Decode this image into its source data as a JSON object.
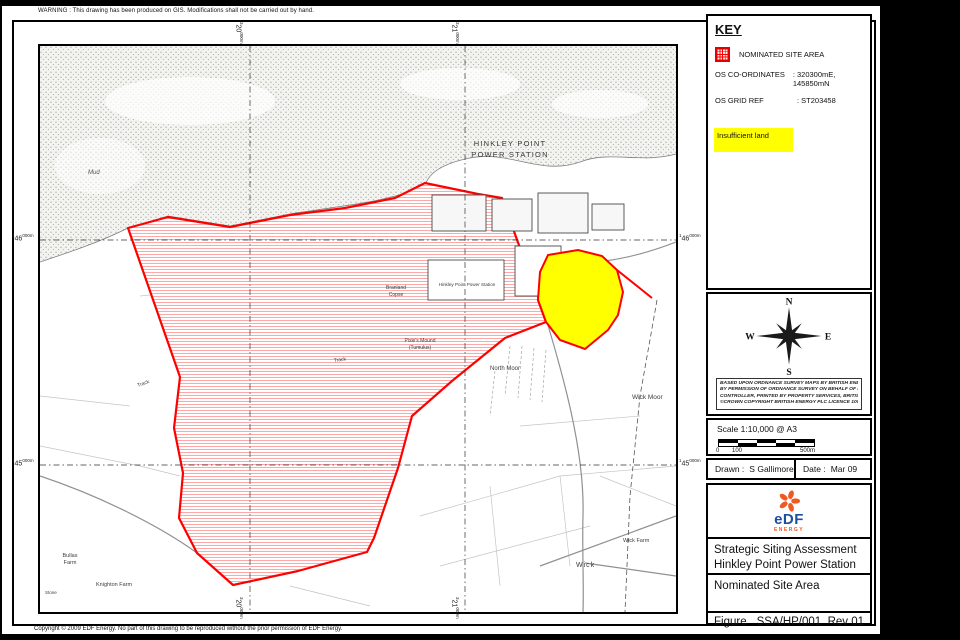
{
  "page": {
    "warning": "WARNING : This drawing has been produced on GIS. Modifications shall not be carried out by hand.",
    "copyright": "Copyright © 2009 EDF Energy. No part of this drawing to be reproduced without the prior permission of EDF Energy."
  },
  "key_panel": {
    "title": "KEY",
    "legend_label": "NOMINATED SITE AREA",
    "rows": [
      {
        "label": "OS CO-ORDINATES",
        "value": ": 320300mE, 145850mN"
      },
      {
        "label": "OS GRID REF",
        "value": ": ST203458"
      }
    ],
    "note": "Insufficient land",
    "note_bg": "#ffff00"
  },
  "compass": {
    "n": "N",
    "e": "E",
    "s": "S",
    "w": "W"
  },
  "credit_lines": [
    "BASED UPON ORDNANCE SURVEY MAPS BY BRITISH ENERGY PLC",
    "BY PERMISSION OF ORDNANCE SURVEY ON BEHALF OF H.M.S.O.",
    "CONTROLLER, PRINTED BY PROPERTY SERVICES, BRITISH ENERGY",
    "©CROWN COPYRIGHT BRITISH ENERGY PLC LICENCE 100024334"
  ],
  "scale_panel": {
    "text": "Scale 1:10,000 @ A3",
    "ticks": [
      "0",
      "100",
      "500m"
    ]
  },
  "drawn_panel": {
    "drawn_label": "Drawn :",
    "drawn_value": "S Gallimore",
    "date_label": "Date :",
    "date_value": "Mar 09"
  },
  "title_block": {
    "logo_text": "eDF",
    "logo_sub": "ENERGY",
    "line1": "Strategic Siting Assessment",
    "line2": "Hinkley Point Power Station",
    "drawing_title": "Nominated Site Area",
    "figure_label": "Figure",
    "figure_number": "SSA/HP/001",
    "revision": "Rev 01"
  },
  "colors": {
    "site_outline": "#ff0000",
    "nominated_yellow": "#ffff00",
    "edf_blue": "#1d4f9f",
    "edf_orange": "#f05a22"
  },
  "map": {
    "labels": [
      {
        "t": "HINKLEY POINT",
        "x": 470,
        "y": 100,
        "s": 7.5,
        "sp": 1.2,
        "a": "middle",
        "c": "#3a3a3a"
      },
      {
        "t": "POWER STATION",
        "x": 470,
        "y": 111,
        "s": 7.5,
        "sp": 1.2,
        "a": "middle",
        "c": "#3a3a3a"
      },
      {
        "t": "Mud",
        "x": 48,
        "y": 128,
        "s": 6,
        "i": 1,
        "c": "#555555"
      },
      {
        "t": "Branland",
        "x": 356,
        "y": 243,
        "s": 5,
        "a": "middle"
      },
      {
        "t": "Copse",
        "x": 356,
        "y": 250,
        "s": 5,
        "a": "middle"
      },
      {
        "t": "Hinkley Point Power Station",
        "x": 427,
        "y": 240,
        "s": 4.6,
        "a": "middle"
      },
      {
        "t": "Pixie's Mound",
        "x": 380,
        "y": 296,
        "s": 5,
        "a": "middle"
      },
      {
        "t": "(Tumulus)",
        "x": 380,
        "y": 303,
        "s": 5,
        "a": "middle"
      },
      {
        "t": "North Moor",
        "x": 450,
        "y": 324,
        "s": 6
      },
      {
        "t": "Wick Moor",
        "x": 592,
        "y": 353,
        "s": 6.5
      },
      {
        "t": "Track",
        "x": 98,
        "y": 341,
        "s": 5,
        "rot": -20
      },
      {
        "t": "Track",
        "x": 294,
        "y": 316,
        "s": 5,
        "rot": -8
      },
      {
        "t": "Bullas",
        "x": 30,
        "y": 511,
        "s": 5.5,
        "a": "middle"
      },
      {
        "t": "Farm",
        "x": 30,
        "y": 518,
        "s": 5.5,
        "a": "middle"
      },
      {
        "t": "Knighton Farm",
        "x": 56,
        "y": 540,
        "s": 5.5
      },
      {
        "t": "Stone",
        "x": 5,
        "y": 548,
        "s": 4.5
      },
      {
        "t": "Wick",
        "x": 536,
        "y": 521,
        "s": 7,
        "sp": 1
      },
      {
        "t": "Wick Farm",
        "x": 583,
        "y": 496,
        "s": 5.5
      }
    ],
    "grid_labels": [
      {
        "pre": "3",
        "main": "20",
        "suf": "000m",
        "x": 243,
        "y": 22,
        "rot": 1
      },
      {
        "pre": "3",
        "main": "21",
        "suf": "000m",
        "x": 459,
        "y": 22,
        "rot": 1
      },
      {
        "pre": "3",
        "main": "20",
        "suf": "000m",
        "x": 243,
        "y": 597,
        "rot": 1
      },
      {
        "pre": "3",
        "main": "21",
        "suf": "000m",
        "x": 459,
        "y": 597,
        "rot": 1
      },
      {
        "pre": "1",
        "main": "46",
        "suf": "000m",
        "x": 12,
        "y": 234,
        "rot": 0
      },
      {
        "pre": "1",
        "main": "45",
        "suf": "000m",
        "x": 12,
        "y": 459,
        "rot": 0
      },
      {
        "pre": "1",
        "main": "46",
        "suf": "000m",
        "x": 679,
        "y": 234,
        "rot": 0
      },
      {
        "pre": "1",
        "main": "45",
        "suf": "000m",
        "x": 679,
        "y": 459,
        "rot": 0
      }
    ]
  }
}
